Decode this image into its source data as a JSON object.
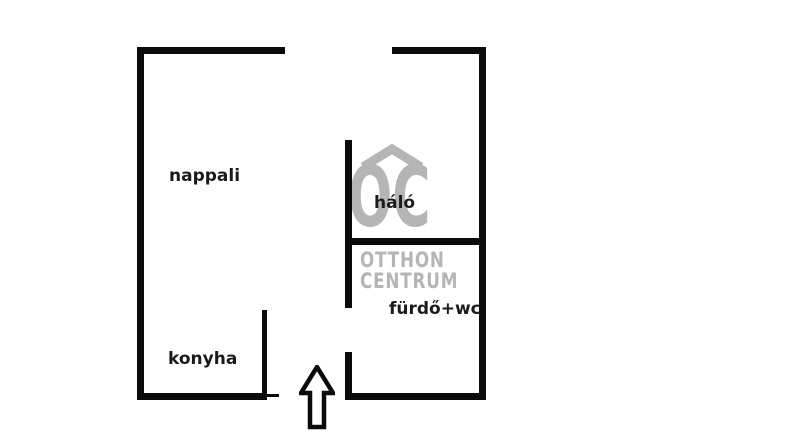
{
  "floorplan": {
    "rooms": [
      {
        "id": "nappali",
        "label": "nappali"
      },
      {
        "id": "halo",
        "label": "háló"
      },
      {
        "id": "furdo",
        "label": "fürdő+wc"
      },
      {
        "id": "konyha",
        "label": "konyha"
      }
    ],
    "entrance": {
      "marker": "up-arrow"
    },
    "colors": {
      "wall": "#0b0b0b",
      "label": "#1b1b1b",
      "background": "#ffffff"
    }
  },
  "watermark": {
    "monogram": "OC",
    "line1": "OTTHON",
    "line2": "CENTRUM",
    "color": "#b5b5b5"
  }
}
